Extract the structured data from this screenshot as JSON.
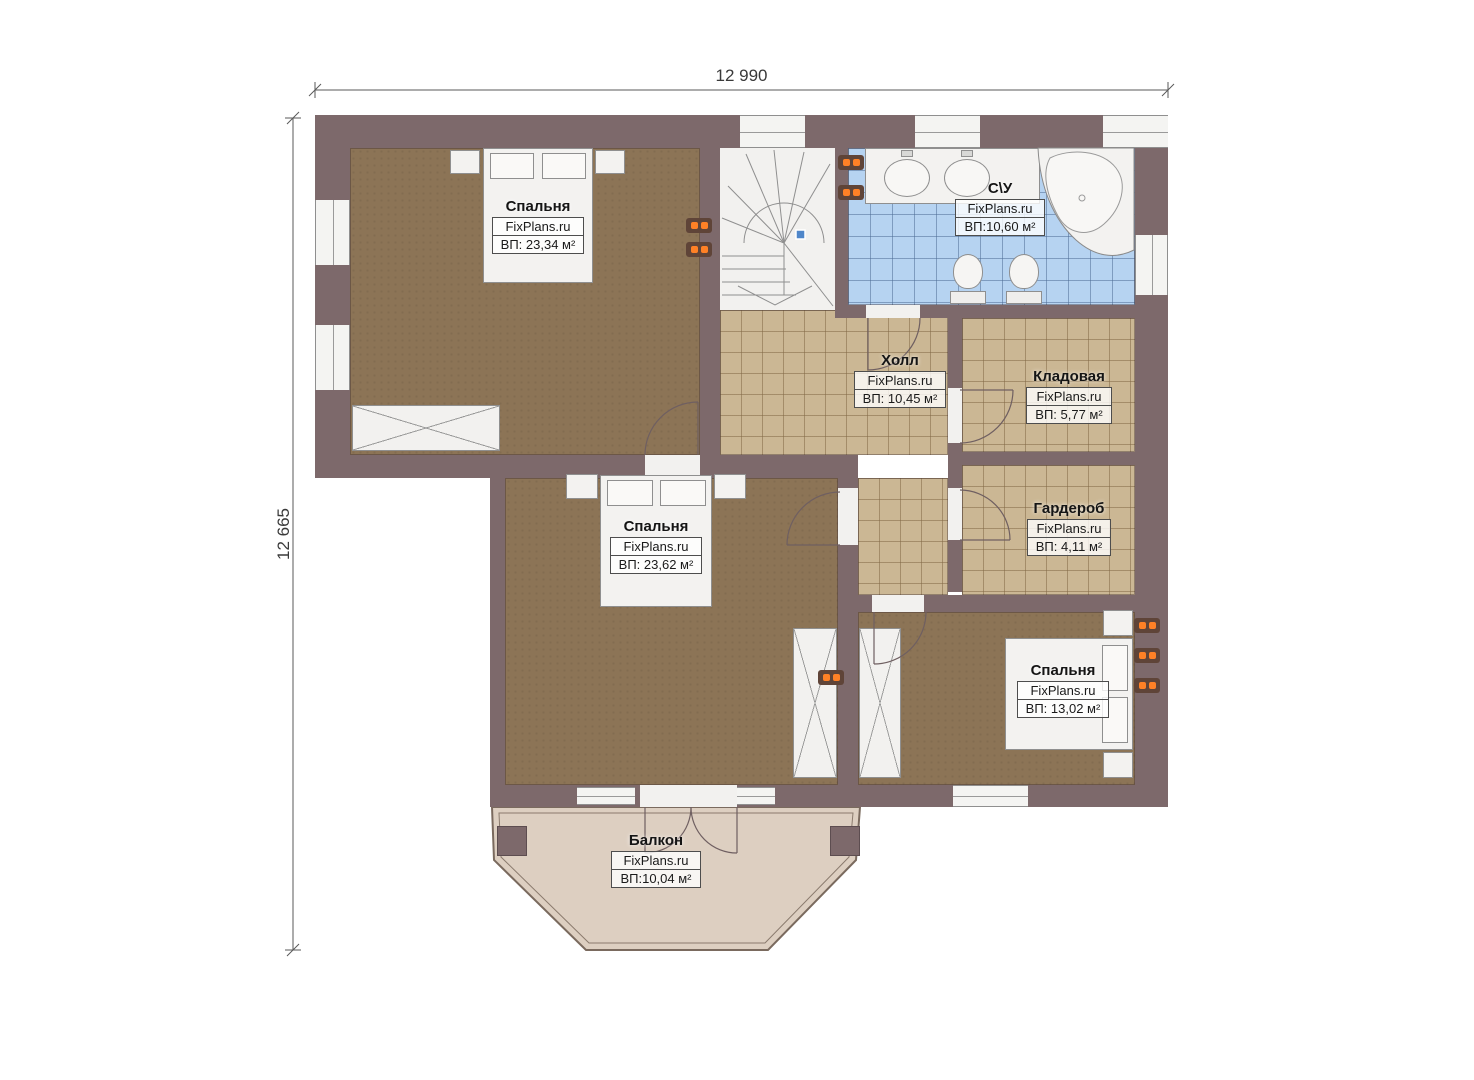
{
  "plan": {
    "type": "floor-plan",
    "brand_watermark": "FixPlans.ru"
  },
  "dimensions": {
    "top": "12 990",
    "left": "12 665"
  },
  "rooms": [
    {
      "id": "bedroom-1",
      "name": "Спальня",
      "brand": "FixPlans.ru",
      "area": "ВП: 23,34 м²"
    },
    {
      "id": "bathroom",
      "name": "С\\У",
      "brand": "FixPlans.ru",
      "area": "ВП:10,60 м²"
    },
    {
      "id": "hall",
      "name": "Холл",
      "brand": "FixPlans.ru",
      "area": "ВП: 10,45 м²"
    },
    {
      "id": "storage",
      "name": "Кладовая",
      "brand": "FixPlans.ru",
      "area": "ВП: 5,77 м²"
    },
    {
      "id": "wardrobe",
      "name": "Гардероб",
      "brand": "FixPlans.ru",
      "area": "ВП: 4,11 м²"
    },
    {
      "id": "bedroom-2",
      "name": "Спальня",
      "brand": "FixPlans.ru",
      "area": "ВП: 23,62 м²"
    },
    {
      "id": "bedroom-3",
      "name": "Спальня",
      "brand": "FixPlans.ru",
      "area": "ВП: 13,02 м²"
    },
    {
      "id": "balcony",
      "name": "Балкон",
      "brand": "FixPlans.ru",
      "area": "ВП:10,04 м²"
    }
  ],
  "colors": {
    "wall": "#7d696b",
    "floor-wood": "#8c7456",
    "tile-tan": "#cbb794",
    "tile-blue": "#b6d3f1",
    "balcony-floor": "#ddcfc1",
    "radiator-orange": "#ff8126",
    "stair-marker-blue": "#4f86c9",
    "label-border": "#4d4d4d"
  }
}
